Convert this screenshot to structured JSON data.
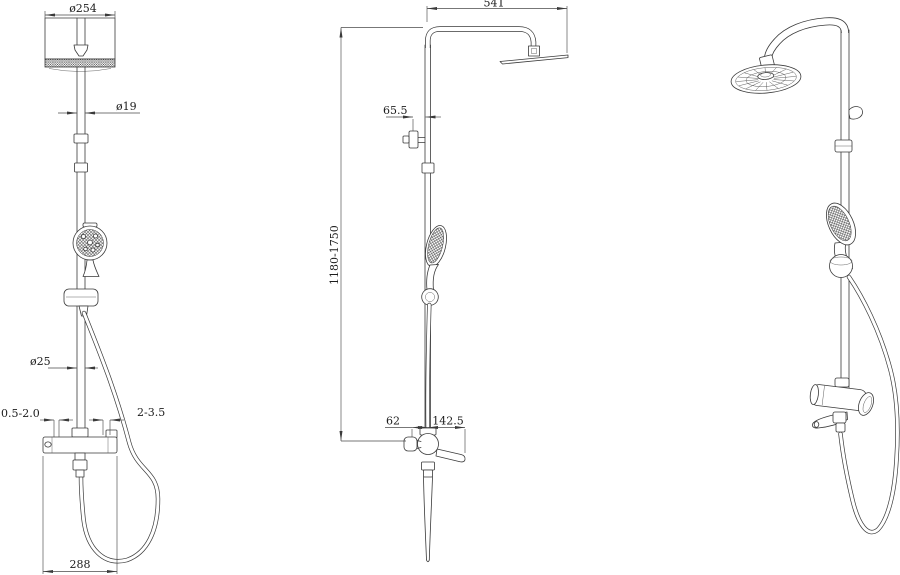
{
  "drawing": {
    "front_view": {
      "head_diameter": "ø254",
      "head_pipe_diameter": "ø19",
      "riser_diameter": "ø25",
      "wall_gap_left": "0.5-2.0",
      "wall_gap_right": "2-3.5",
      "valve_width": "288"
    },
    "side_view": {
      "arm_reach": "541",
      "bracket_offset": "65.5",
      "height_range": "1180-1750",
      "handle_offset": "62",
      "spout_reach": "142.5"
    }
  }
}
